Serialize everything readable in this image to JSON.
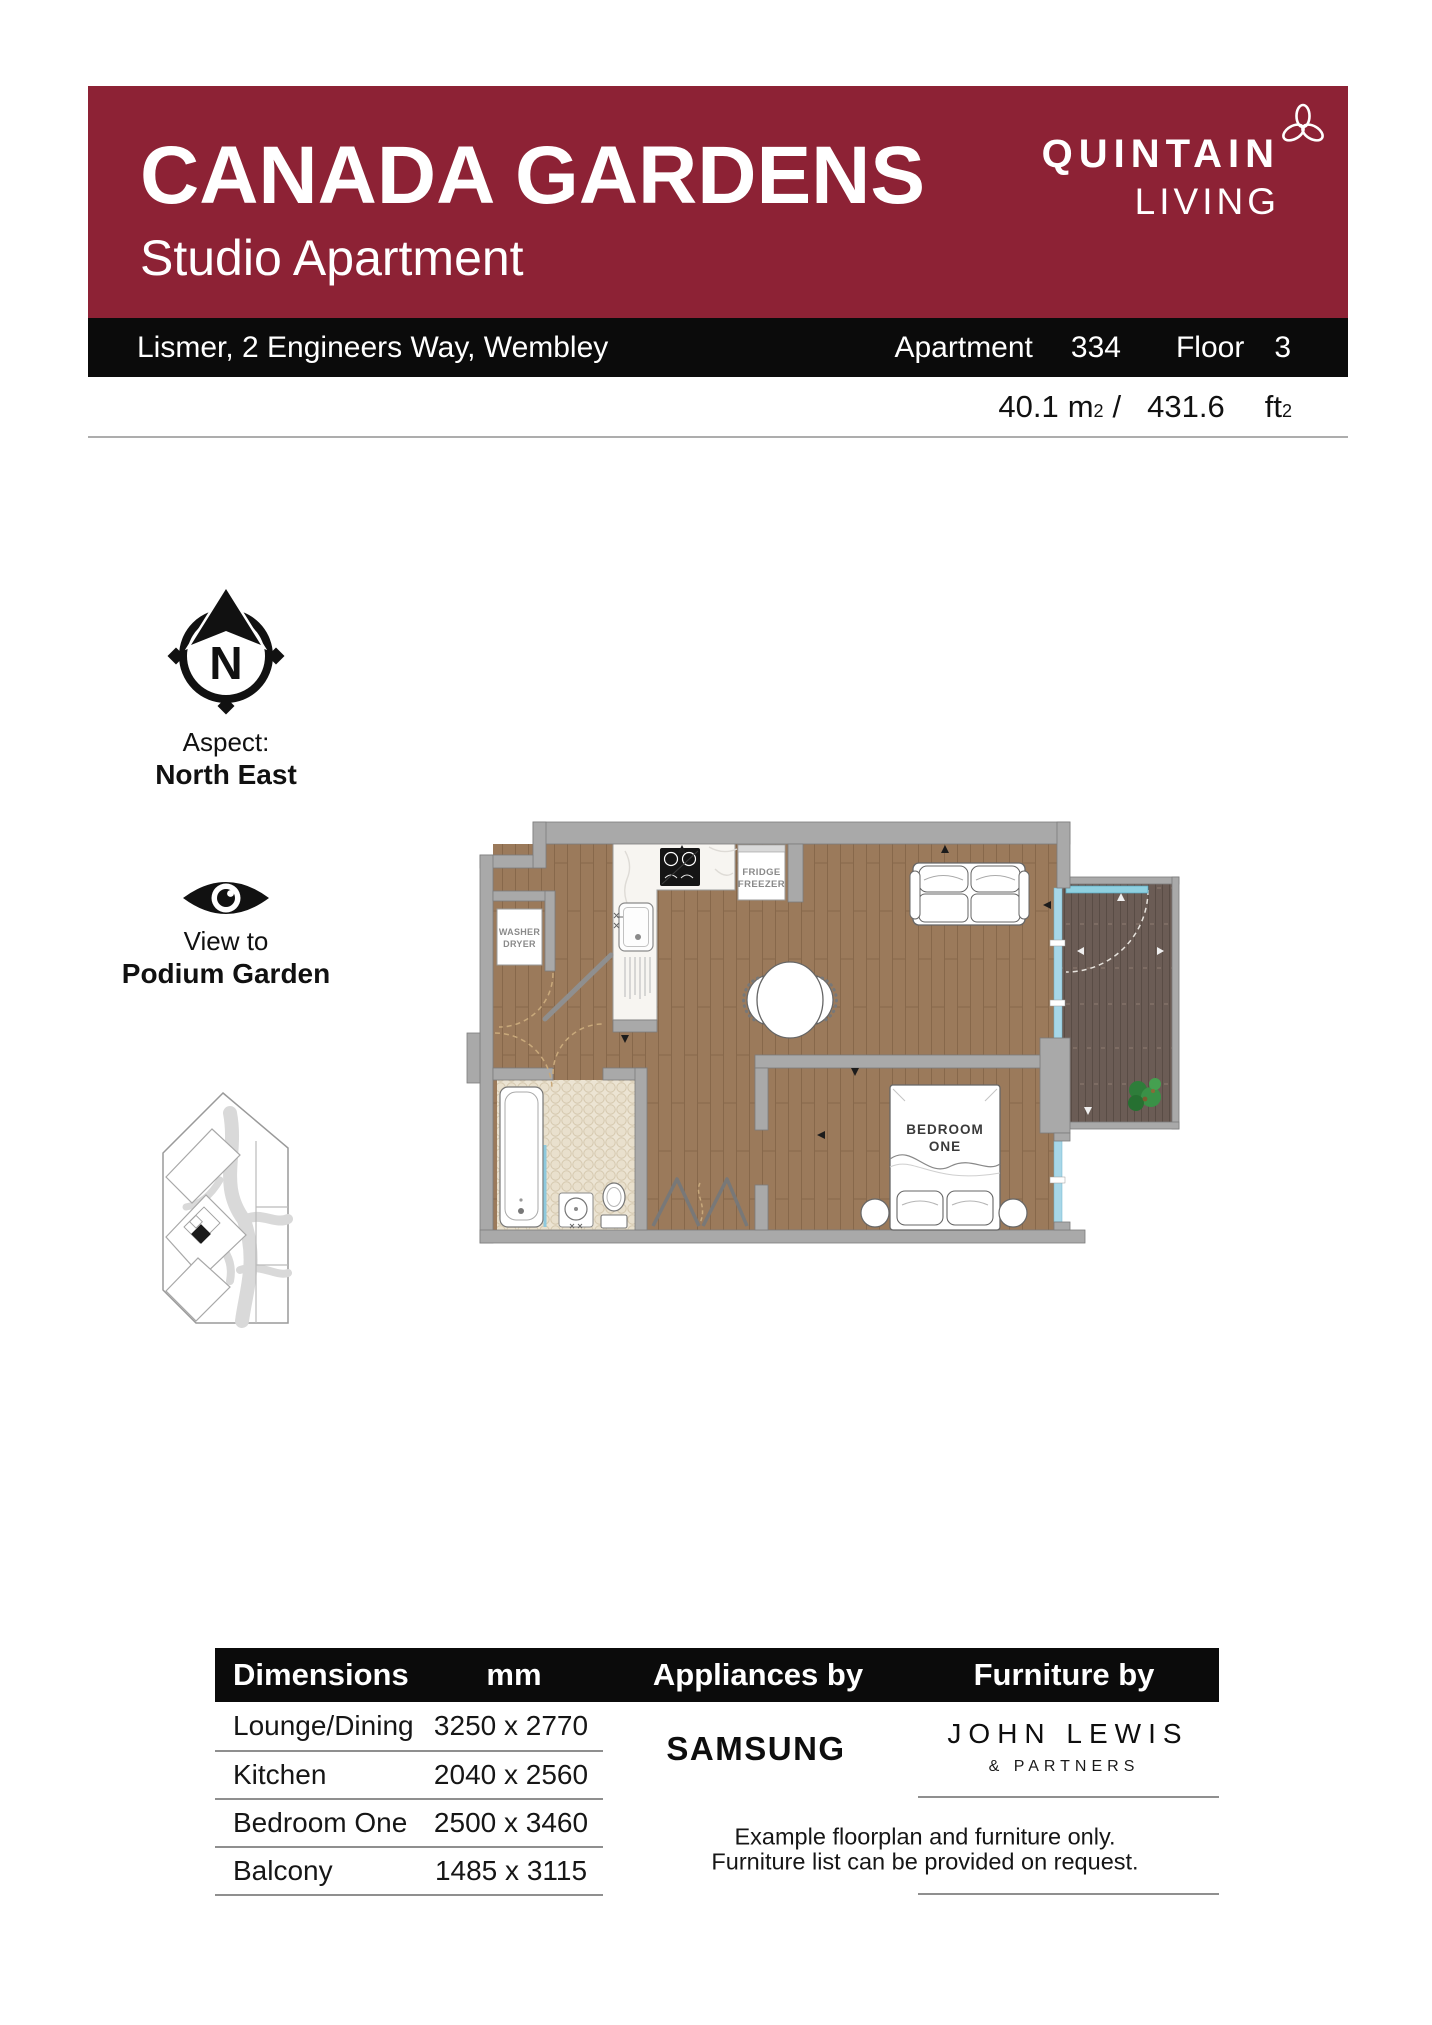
{
  "header": {
    "title": "CANADA GARDENS",
    "subtitle": "Studio Apartment",
    "brand_line1": "QUINTAIN",
    "brand_line2": "LIVING",
    "address": "Lismer, 2 Engineers Way, Wembley",
    "apartment_label": "Apartment",
    "apartment_number": "334",
    "floor_label": "Floor",
    "floor_number": "3",
    "area_metric_value": "40.1",
    "area_metric_unit": "m",
    "area_slash": "/",
    "area_imperial_value": "431.6",
    "area_imperial_unit": "ft",
    "superscript": "2"
  },
  "aspect": {
    "label": "Aspect:",
    "value": "North East"
  },
  "view": {
    "label": "View to",
    "value": "Podium Garden"
  },
  "floorplan": {
    "bedroom_label_line1": "BEDROOM",
    "bedroom_label_line2": "ONE",
    "fridge_line1": "FRIDGE",
    "fridge_line2": "FREEZER",
    "washer_line1": "WASHER",
    "washer_line2": "DRYER"
  },
  "dimensions_table": {
    "header_dimensions": "Dimensions",
    "header_mm": "mm",
    "header_appliances": "Appliances by",
    "header_furniture": "Furniture by",
    "rows": [
      {
        "label": "Lounge/Dining",
        "value": "3250 x 2770"
      },
      {
        "label": "Kitchen",
        "value": "2040 x 2560"
      },
      {
        "label": "Bedroom One",
        "value": "2500 x 3460"
      },
      {
        "label": "Balcony",
        "value": "1485 x 3115"
      }
    ],
    "appliances_brand": "SAMSUNG",
    "furniture_brand_line1": "JOHN LEWIS",
    "furniture_brand_line2": "& PARTNERS",
    "note_line1": "Example floorplan and furniture only.",
    "note_line2": "Furniture list can be provided on request."
  },
  "colors": {
    "brand_red": "#8d2235",
    "bar_black": "#0b0b0b",
    "wall_gray": "#a9a9a9",
    "floor_wood": "#9b7a5b",
    "balcony_deck": "#6b5c55",
    "bath_tile": "#ece4d3",
    "glazing_blue": "#a7d7e8",
    "plant_green": "#2e7d3a"
  }
}
